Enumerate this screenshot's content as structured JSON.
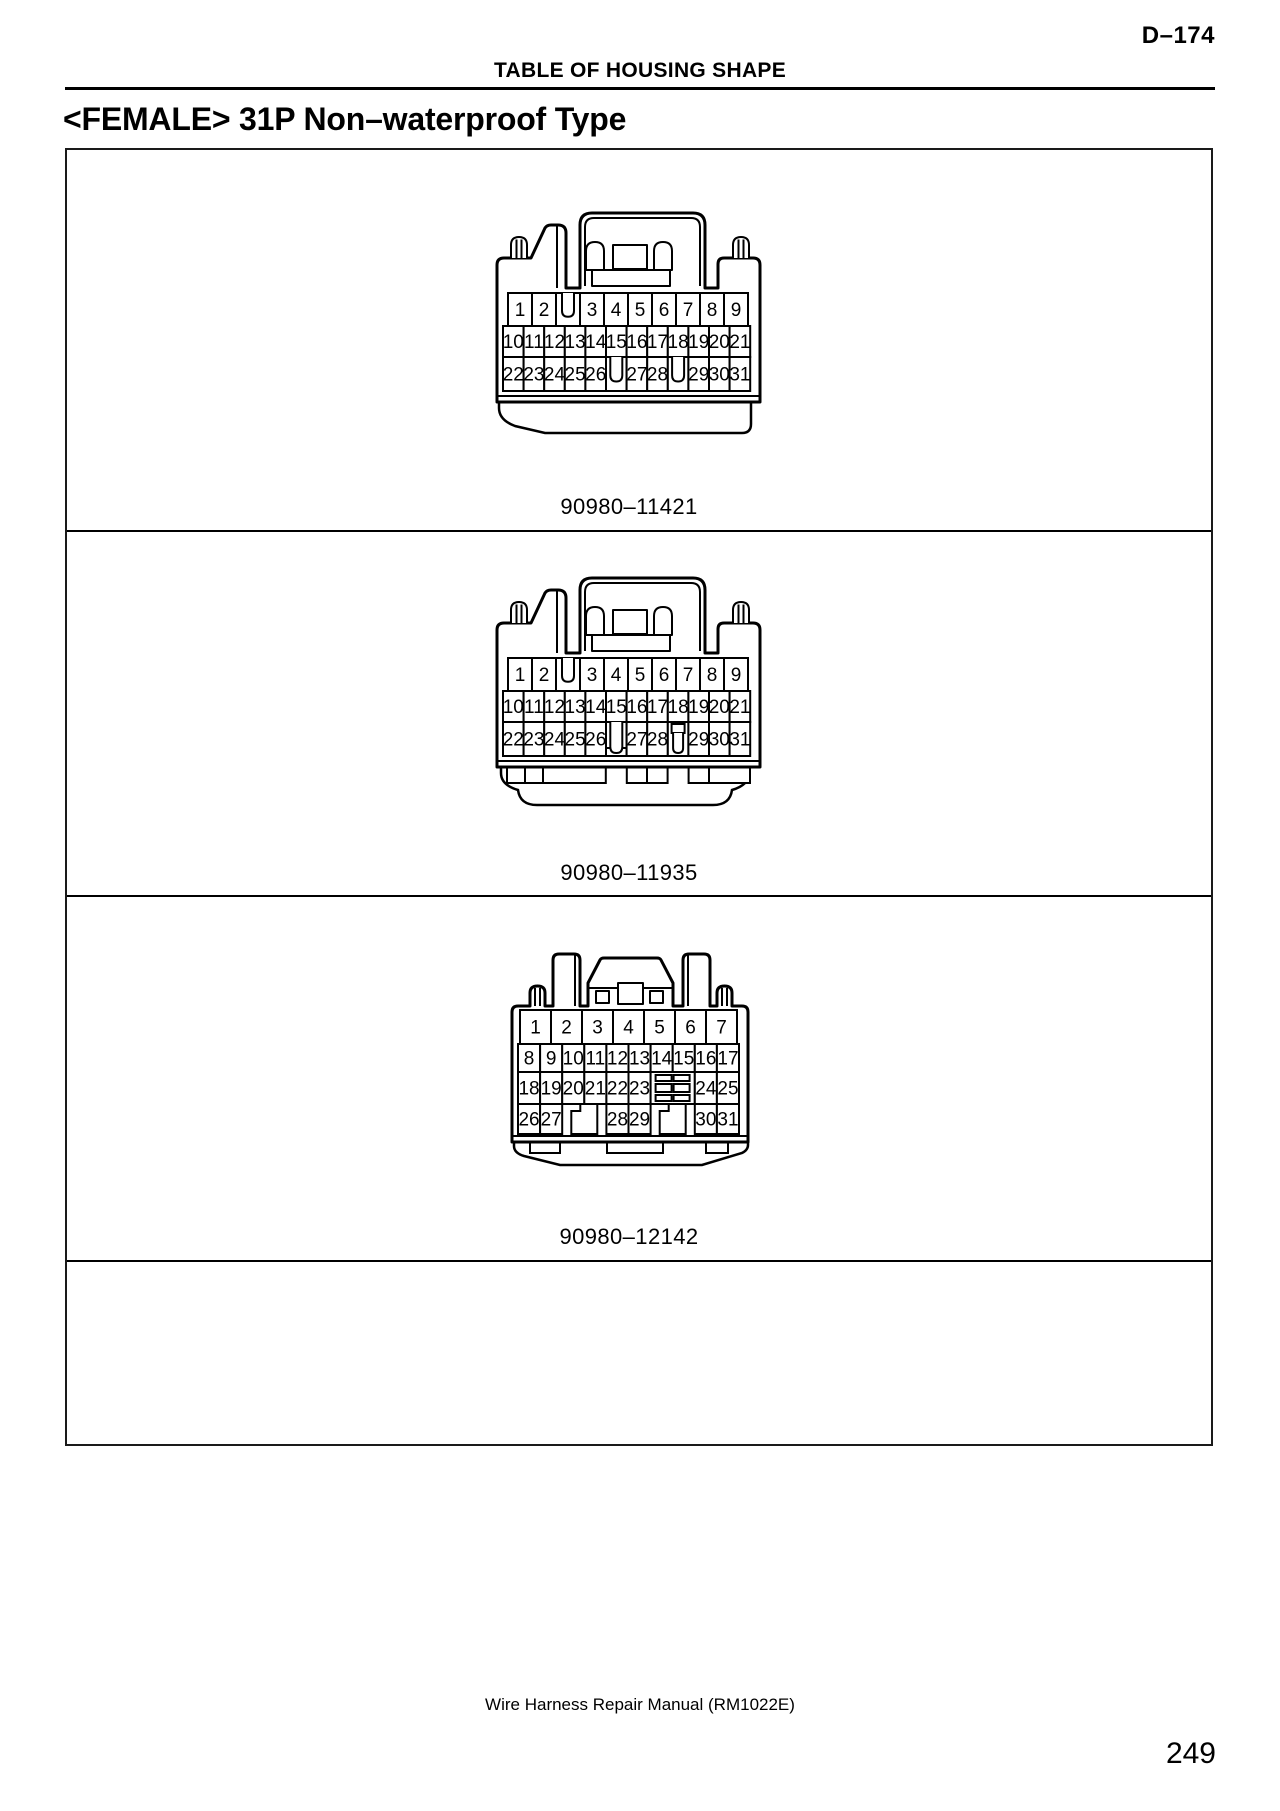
{
  "page": {
    "page_ref": "D–174",
    "header_title": "TABLE OF HOUSING SHAPE",
    "title": "<FEMALE> 31P Non–waterproof Type",
    "footer": "Wire Harness Repair Manual (RM1022E)",
    "page_number": "249"
  },
  "connectors": [
    {
      "part_number": "90980–11421",
      "rows": [
        {
          "cells": [
            "1",
            "2",
            "|",
            "3",
            "4",
            "5",
            "6",
            "7",
            "8",
            "9"
          ]
        },
        {
          "cells": [
            "10",
            "11",
            "12",
            "13",
            "14",
            "15",
            "16",
            "17",
            "18",
            "19",
            "20",
            "21"
          ]
        },
        {
          "cells": [
            "22",
            "23",
            "24",
            "25",
            "26",
            "|",
            "27",
            "28",
            "|",
            "29",
            "30",
            "31"
          ]
        }
      ]
    },
    {
      "part_number": "90980–11935",
      "rows": [
        {
          "cells": [
            "1",
            "2",
            "|",
            "3",
            "4",
            "5",
            "6",
            "7",
            "8",
            "9"
          ]
        },
        {
          "cells": [
            "10",
            "11",
            "12",
            "13",
            "14",
            "15",
            "16",
            "17",
            "18",
            "19",
            "20",
            "21"
          ]
        },
        {
          "cells": [
            "22",
            "23",
            "24",
            "25",
            "26",
            "T",
            "27",
            "28",
            "S",
            "29",
            "30",
            "31"
          ]
        }
      ]
    },
    {
      "part_number": "90980–12142",
      "rows": [
        {
          "cells": [
            "1",
            "2",
            "3",
            "4",
            "5",
            "6",
            "7"
          ]
        },
        {
          "cells": [
            "8",
            "9",
            "10",
            "11",
            "12",
            "13",
            "14",
            "15",
            "16",
            "17"
          ]
        },
        {
          "cells": [
            "18",
            "19",
            "20",
            "21",
            "22",
            "23",
            "#",
            "24",
            "25"
          ]
        },
        {
          "cells": [
            "26",
            "27",
            "|",
            "28",
            "29",
            "|",
            "30",
            "31"
          ]
        }
      ]
    }
  ]
}
